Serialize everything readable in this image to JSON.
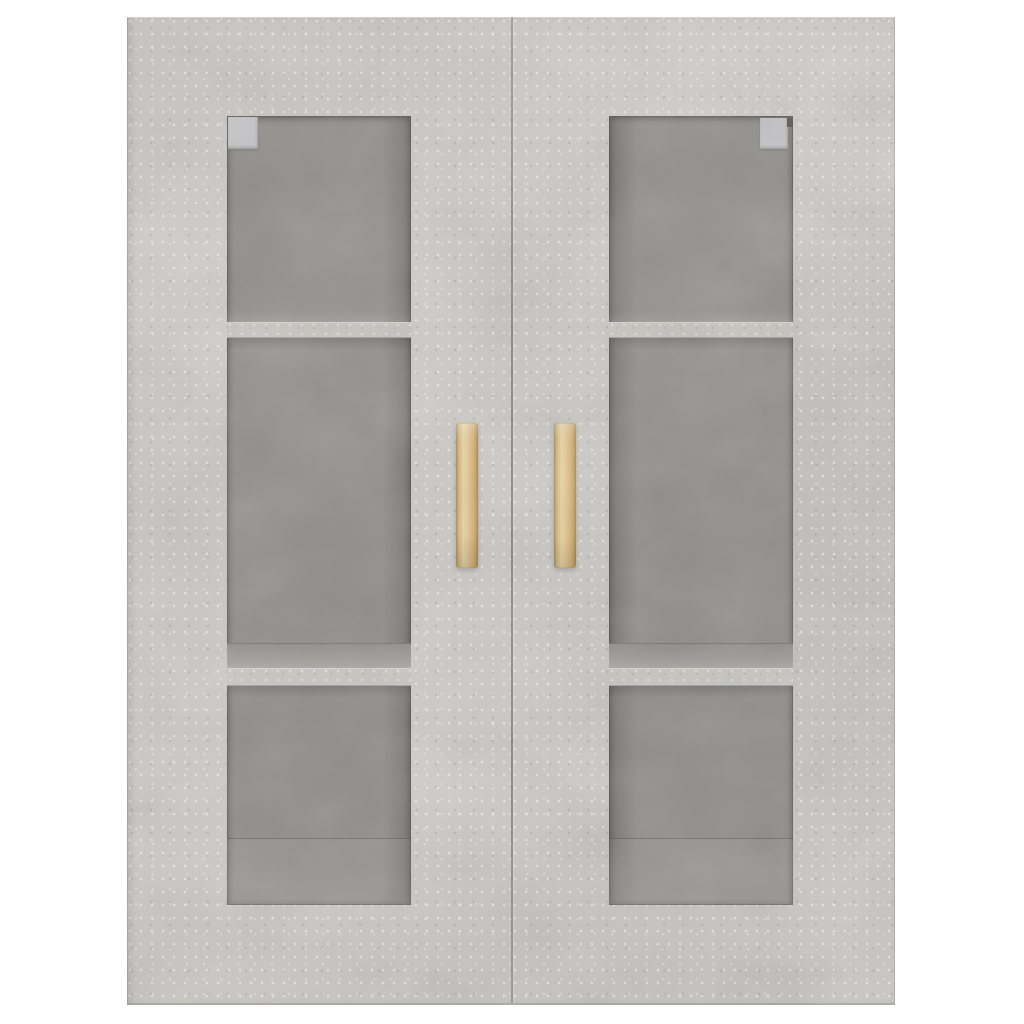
{
  "scene": {
    "type": "product-photo",
    "description": "Concrete-grey wall-mounted cabinet, front view, on a white background. Two framed glass doors reveal three interior compartments per side separated by two shelves. Each door has a vertical light-wood bar handle near the centre gap, and a metal hinge clip is visible through the glass at the top inner corner of each window.",
    "object": "wall cabinet",
    "finish": "concrete grey",
    "background": "white"
  },
  "structure": {
    "doors": 2,
    "glass_windows": 2,
    "shelves_per_window": 2,
    "compartments_per_window": 3,
    "handles": 2,
    "handle_material": "light wood",
    "hinge_clips_visible": 2
  },
  "colors": {
    "page_bg": "#ffffff",
    "concrete_base": "#c8c7c2",
    "concrete_light": "#deddd8",
    "concrete_dark": "#b3b2ad",
    "interior_dark": "#8e8b87",
    "interior_light": "#a4a19c",
    "shelf_front": "#c7c6c0",
    "handle_wood_light": "#ecd6a4",
    "handle_wood_mid": "#e4c78f",
    "handle_wood_dark": "#b2914f",
    "hinge_clip": "#c5c5c7",
    "hinge_notch": "#55534f",
    "door_gap": "#686661"
  }
}
